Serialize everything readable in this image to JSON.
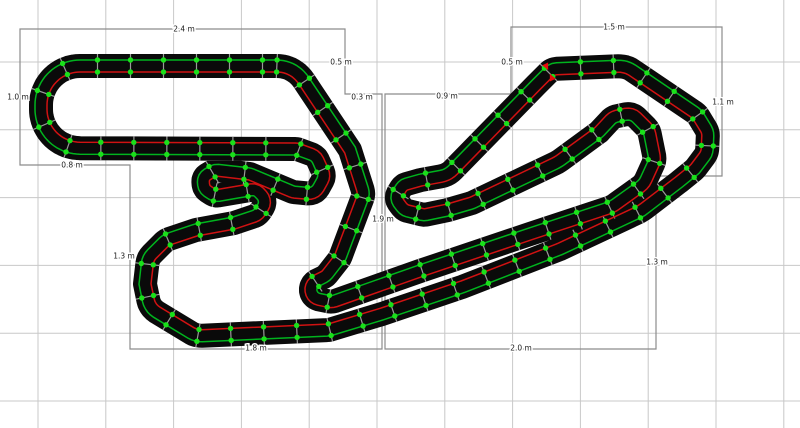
{
  "app": {
    "name": "track-layout-editor",
    "view": "layout-plan-canvas"
  },
  "canvas": {
    "width": 800,
    "height": 428,
    "background": "#ffffff"
  },
  "grid": {
    "color": "#c8c8c8",
    "spacing_px": 67.8,
    "offset_x": 38.0,
    "offset_y": 62.0,
    "meters_per_cell": 0.5
  },
  "colors": {
    "track": "#0a0a0a",
    "lane_red": "#d01212",
    "lane_green": "#00b41e",
    "joint_dot": "#1ae01a",
    "joint_tick": "#9a9a9a",
    "bounds": "#8c8c8c",
    "label_text": "#1c1c1c",
    "start_marker": "#e80c0c"
  },
  "section_bounds": [
    {
      "name": "left-section",
      "points": [
        [
          20,
          29
        ],
        [
          345,
          29
        ],
        [
          345,
          94
        ],
        [
          382,
          94
        ],
        [
          382,
          349
        ],
        [
          130,
          349
        ],
        [
          130,
          165
        ],
        [
          20,
          165
        ]
      ]
    },
    {
      "name": "right-section",
      "points": [
        [
          385,
          94
        ],
        [
          511,
          94
        ],
        [
          511,
          27
        ],
        [
          722,
          27
        ],
        [
          722,
          176
        ],
        [
          656,
          176
        ],
        [
          656,
          349
        ],
        [
          385,
          349
        ]
      ]
    }
  ],
  "dimension_labels": [
    {
      "text": "2.4 m",
      "x": 184,
      "y": 29
    },
    {
      "text": "0.5 m",
      "x": 341,
      "y": 62
    },
    {
      "text": "0.3 m",
      "x": 362,
      "y": 97
    },
    {
      "text": "1.0 m",
      "x": 18,
      "y": 97
    },
    {
      "text": "0.8 m",
      "x": 72,
      "y": 165
    },
    {
      "text": "1.3 m",
      "x": 124,
      "y": 256
    },
    {
      "text": "1.8 m",
      "x": 256,
      "y": 348
    },
    {
      "text": "1.9 m",
      "x": 383,
      "y": 219
    },
    {
      "text": "0.9 m",
      "x": 447,
      "y": 96
    },
    {
      "text": "0.5 m",
      "x": 512,
      "y": 62
    },
    {
      "text": "1.5 m",
      "x": 614,
      "y": 27
    },
    {
      "text": "1.1 m",
      "x": 723,
      "y": 102
    },
    {
      "text": "1.3 m",
      "x": 657,
      "y": 262
    },
    {
      "text": "2.0 m",
      "x": 521,
      "y": 348
    }
  ],
  "track": {
    "half_width_px": 12,
    "lane_offset_px": 6,
    "lane_line_width": 1.5,
    "joint_spacing_px": 33,
    "dot_radius": 2.7,
    "waypoints": [
      [
        294,
        66,
        32
      ],
      [
        350,
        150,
        0
      ],
      [
        364,
        194,
        14
      ],
      [
        340,
        258,
        13
      ],
      [
        326,
        276,
        11
      ],
      [
        310,
        284,
        10
      ],
      [
        312,
        298,
        10
      ],
      [
        332,
        302,
        12
      ],
      [
        420,
        271,
        40
      ],
      [
        530,
        234,
        55
      ],
      [
        612,
        207,
        30
      ],
      [
        644,
        184,
        17
      ],
      [
        655,
        160,
        13
      ],
      [
        649,
        130,
        14
      ],
      [
        632,
        113,
        12
      ],
      [
        613,
        117,
        11
      ],
      [
        599,
        132,
        13
      ],
      [
        558,
        162,
        40
      ],
      [
        472,
        203,
        28
      ],
      [
        448,
        210,
        14
      ],
      [
        424,
        215,
        11
      ],
      [
        404,
        210,
        10
      ],
      [
        395,
        198,
        9
      ],
      [
        403,
        185,
        9
      ],
      [
        421,
        180,
        11
      ],
      [
        448,
        175,
        22
      ],
      [
        536,
        85,
        18
      ],
      [
        552,
        69,
        12
      ],
      [
        626,
        66,
        24
      ],
      [
        697,
        114,
        15
      ],
      [
        708,
        132,
        13
      ],
      [
        707,
        153,
        13
      ],
      [
        695,
        169,
        13
      ],
      [
        679,
        182,
        15
      ],
      [
        641,
        211,
        40
      ],
      [
        560,
        249,
        60
      ],
      [
        462,
        287,
        55
      ],
      [
        382,
        314,
        40
      ],
      [
        329,
        330,
        18
      ],
      [
        196,
        336,
        20
      ],
      [
        150,
        308,
        18
      ],
      [
        145,
        284,
        0
      ],
      [
        148,
        258,
        16
      ],
      [
        166,
        240,
        15
      ],
      [
        196,
        230,
        14
      ],
      [
        234,
        223,
        12
      ],
      [
        258,
        215,
        12
      ],
      [
        267,
        201,
        10
      ],
      [
        256,
        189,
        9
      ],
      [
        238,
        192,
        10
      ],
      [
        215,
        196,
        10
      ],
      [
        204,
        189,
        9
      ],
      [
        203,
        177,
        8
      ],
      [
        215,
        170,
        9
      ],
      [
        250,
        174,
        14
      ],
      [
        293,
        192,
        12
      ],
      [
        315,
        194,
        11
      ],
      [
        325,
        176,
        11
      ],
      [
        316,
        156,
        11
      ],
      [
        297,
        149,
        10
      ],
      [
        41,
        148,
        39
      ],
      [
        41,
        66,
        39
      ]
    ]
  },
  "start_marker": {
    "x": 549,
    "y": 72,
    "angle_deg": -25
  }
}
